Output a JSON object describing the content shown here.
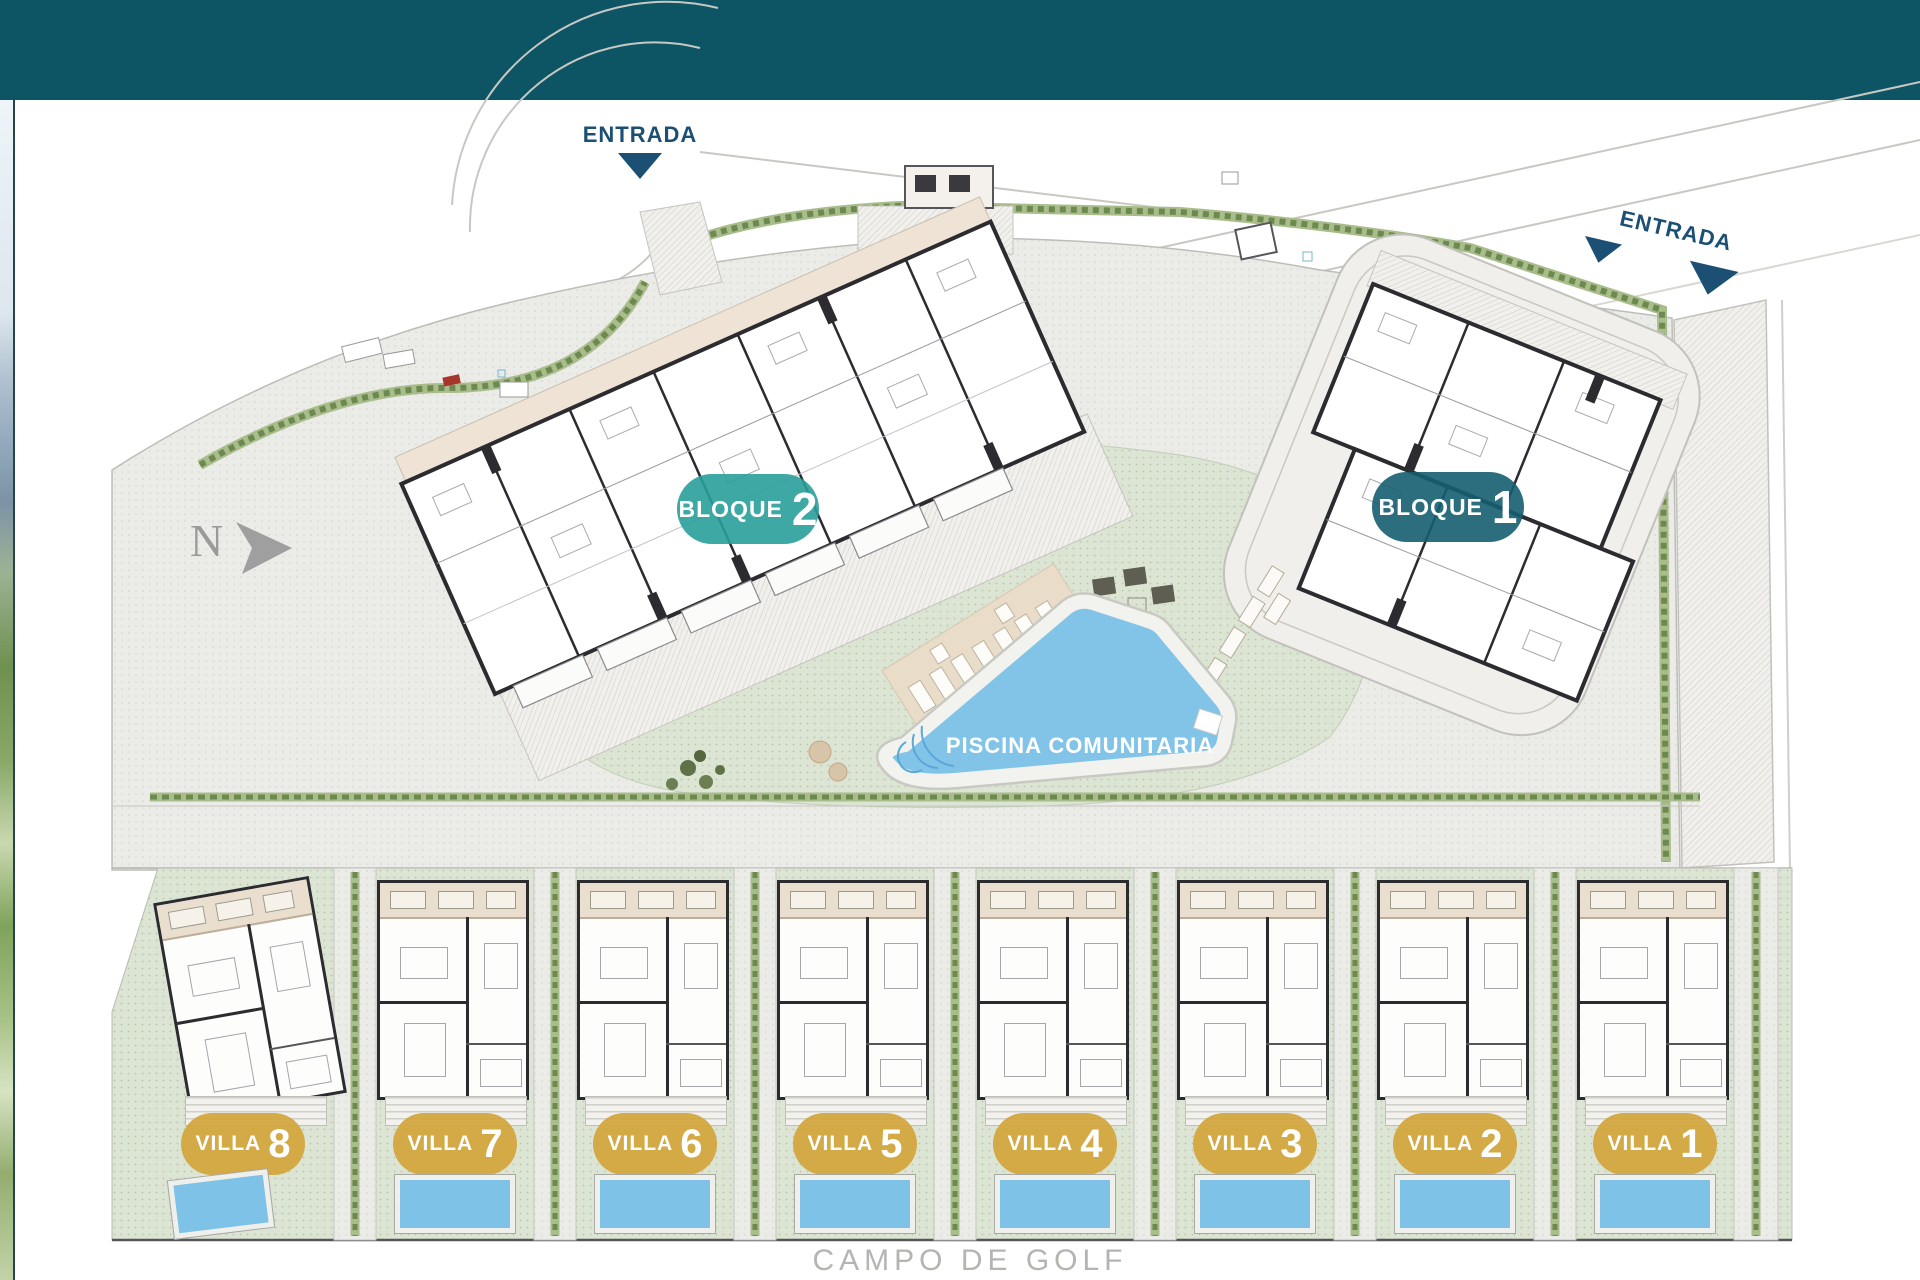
{
  "labels": {
    "entrance_top": "ENTRADA",
    "entrance_right": "ENTRADA",
    "pool": "PISCINA COMUNITARIA",
    "golf_course": "CAMPO DE GOLF",
    "north": "N"
  },
  "blocks": [
    {
      "label": "BLOQUE",
      "number": "2",
      "color": "#29a09a"
    },
    {
      "label": "BLOQUE",
      "number": "1",
      "color": "#155e70"
    }
  ],
  "villas": [
    {
      "label": "VILLA",
      "number": "8"
    },
    {
      "label": "VILLA",
      "number": "7"
    },
    {
      "label": "VILLA",
      "number": "6"
    },
    {
      "label": "VILLA",
      "number": "5"
    },
    {
      "label": "VILLA",
      "number": "4"
    },
    {
      "label": "VILLA",
      "number": "3"
    },
    {
      "label": "VILLA",
      "number": "2"
    },
    {
      "label": "VILLA",
      "number": "1"
    }
  ],
  "colors": {
    "top_bar": "#0d5464",
    "block2_badge": "#29a09a",
    "block1_badge": "#155e70",
    "villa_badge": "#d3a63c",
    "pool_water": "#82c4e8",
    "entrance_marker": "#1c4f74",
    "hedge_green": "#6d8a4e",
    "ground_green": "#dce4d3",
    "paving_gray": "#ebebe8"
  }
}
